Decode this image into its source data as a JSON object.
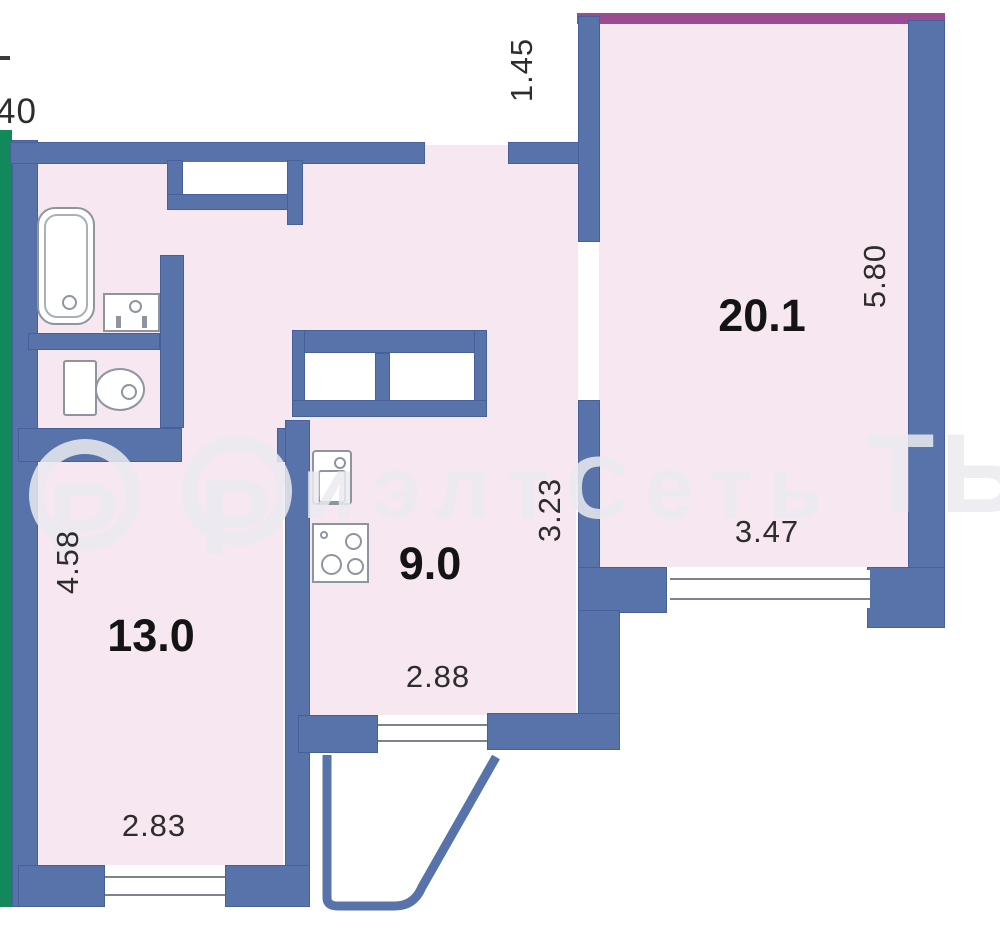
{
  "plan": {
    "watermark": {
      "circle_letter": "Р",
      "text": "иэлтСеть",
      "tail": "ТЬ"
    },
    "labels": {
      "dim_top_left": "40",
      "dim_entry": "1.45",
      "room_20_1": "20.1",
      "dim_room20_height": "5.80",
      "dim_room20_width": "3.47",
      "dim_kitchen_height": "3.23",
      "kitchen": "9.0",
      "dim_kitchen_width": "2.88",
      "room_13_0": "13.0",
      "dim_room13_height": "4.58",
      "dim_room13_width": "2.83"
    },
    "colors": {
      "wall": "#5872aa",
      "wall_edge": "#46609b",
      "floor": "#f6e7f0",
      "green": "#12895a",
      "purple": "#9b4b92",
      "watermark": "#ebebf0",
      "text": "#2d2d2d",
      "fixture": "#8e959f",
      "window_line": "#7c8290"
    }
  }
}
